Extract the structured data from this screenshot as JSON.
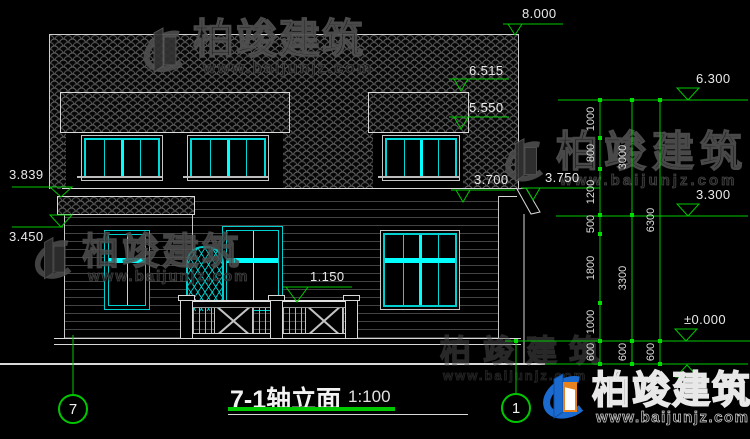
{
  "drawing": {
    "title": "7-1轴立面",
    "scale": "1:100",
    "axis_left": "7",
    "axis_right": "1",
    "elevation_markers": {
      "ridge": "8.000",
      "dormer_top": "6.515",
      "dormer_eave": "5.550",
      "left_upper": "3.839",
      "left_lower": "3.450",
      "eave_right": "3.700",
      "eave_overhang": "3.750",
      "railing": "1.150",
      "right_top": "6.300",
      "right_mid": "3.300",
      "zero": "±0.000"
    },
    "chains": {
      "inner": [
        "1000",
        "800",
        "1200",
        "500",
        "1800",
        "1000",
        "600"
      ],
      "middle": [
        "3000",
        "3300",
        "600"
      ],
      "outer": [
        "6300",
        "600"
      ]
    }
  },
  "watermark": {
    "brand": "柏竣建筑",
    "url": "www.baijunjz.com"
  },
  "colors": {
    "annotation_green": "#00c800",
    "window_cyan": "#00d9d9",
    "highlight_cyan": "#00ffff",
    "logo_blue": "#1b6ad0",
    "logo_orange": "#e8821e"
  }
}
